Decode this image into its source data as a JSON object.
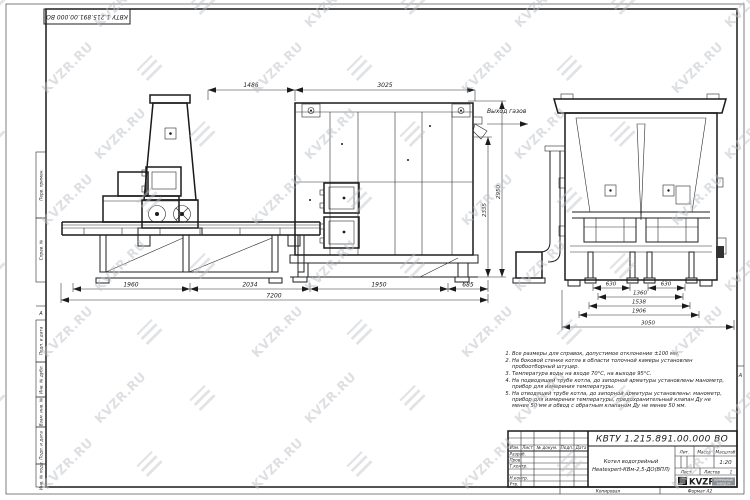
{
  "sheet": {
    "margin_labels": [
      "Перв. примен.",
      "Справ. №",
      "Подп. и дата",
      "Инв. № дубл.",
      "Взам. инв. №",
      "Подп. и дата",
      "Инв. № подл."
    ],
    "zone_marker": "А",
    "copied_label": "Копировал",
    "format_label": "Формат А2"
  },
  "watermark": {
    "text": "KVZR.RU",
    "color": "#bcc1c6"
  },
  "drawing": {
    "gas_outlet_label": "Выход газов",
    "side_view": {
      "dims_top": [
        "1486",
        "3025"
      ],
      "dims_right": [
        "2335",
        "2950"
      ],
      "dims_bottom": [
        "1960",
        "2034",
        "1950",
        "685"
      ],
      "dim_total": "7200"
    },
    "end_view": {
      "dims": [
        "630",
        "630",
        "1360",
        "1538",
        "1906",
        "3050"
      ]
    }
  },
  "notes": {
    "items": [
      "Все размеры для справок, допустимое отклонение ±100 мм.",
      "На боковой стенке котла в области топочной камеры установлен пробоотборный штуцер.",
      "Температура воды на входе 70°С, на выходе 95°С.",
      "На подводящей трубе котла, до запорной арматуры установлены манометр, прибор для измерения температуры.",
      "На отводящей трубе котла, до запорной арматуры установлены: манометр, прибор для измерения температуры, предохранительный клапан Ду не менее 50 мм и обвод с обратным клапаном Ду не менее 50 мм."
    ]
  },
  "title_block": {
    "doc_number": "КВТУ 1.215.891.00.000 ВО",
    "product_name_line1": "Котел водогрейный",
    "product_name_line2": "Heatexpert-КВм-2,5-ДО(ВПЛ)",
    "col_izm": "Изм.",
    "col_list": "Лист",
    "col_doc": "№ докум.",
    "col_podp": "Подп.",
    "col_data": "Дата",
    "row_razrab": "Разраб.",
    "row_prov": "Пров.",
    "row_tkontr": "Т.контр.",
    "row_nkontr": "Н.контр.",
    "row_utv": "Утв.",
    "lit_label": "Лит.",
    "mass_label": "Масса",
    "scale_label": "Масштаб",
    "scale_value": "1:20",
    "sheet_label": "Лист",
    "sheets_label": "Листов",
    "sheets_value": "1",
    "logo_text": "KVZR",
    "logo_sub1": "КОТЕЛЬНЫЙ",
    "logo_sub2": "ЗАВОД.РУ"
  }
}
